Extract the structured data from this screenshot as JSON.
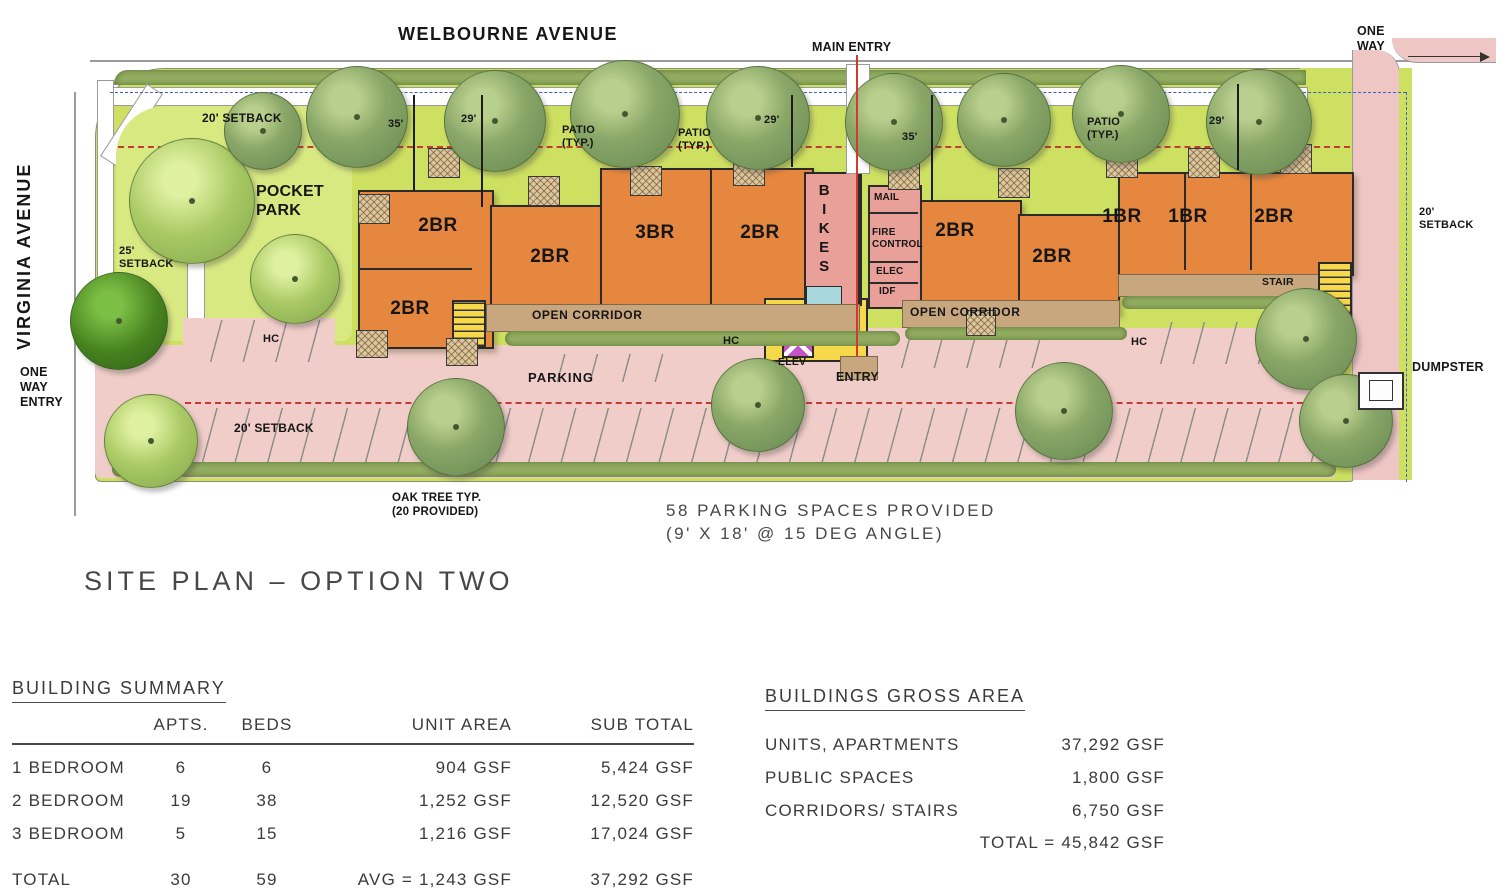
{
  "colors": {
    "building": "#e5873f",
    "grass": "#cde061",
    "grass_light": "#d9e982",
    "hedge": "#94ae62",
    "parking": "#f0cdc8",
    "road": "#eec6c4",
    "tree": "#8aa768",
    "tree_light": "#a9c964",
    "tree_dark": "#47821f",
    "corridor_yellow": "#f7d84b",
    "utility_pink": "#e8a099",
    "elevator": "#c453c8",
    "water": "#a8d7de",
    "walk_tan": "#c9a77e",
    "outline": "#2b2b2b",
    "setback_red": "#c23b35",
    "property_blue": "#3c5fc4"
  },
  "plan": {
    "streets": {
      "welbourne": "WELBOURNE AVENUE",
      "virginia": "VIRGINIA AVENUE",
      "main_entry": "MAIN ENTRY",
      "one_way_top": "ONE\nWAY",
      "one_way_entry": "ONE\nWAY\nENTRY"
    },
    "park": {
      "pocket": "POCKET\nPARK"
    },
    "setbacks": {
      "s20": "20' SETBACK",
      "s20_stacked": "20'\nSETBACK",
      "s25": "25'\nSETBACK"
    },
    "dims": {
      "d35": "35'",
      "d29": "29'"
    },
    "patio": "PATIO\n(TYP.)",
    "units": [
      "2BR",
      "2BR",
      "3BR",
      "2BR",
      "2BR",
      "2BR",
      "2BR",
      "1BR",
      "1BR",
      "2BR"
    ],
    "rooms": {
      "bikes": "BIKES",
      "mail": "MAIL",
      "fire_control": "FIRE\nCONTROL",
      "elec": "ELEC",
      "idf": "IDF",
      "elev": "ELEV",
      "stair": "STAIR"
    },
    "labels": {
      "open_corridor": "OPEN CORRIDOR",
      "entry": "ENTRY",
      "parking": "PARKING",
      "hc": "HC",
      "dumpster": "DUMPSTER"
    },
    "notes": {
      "oak": "OAK TREE TYP.\n(20 PROVIDED)",
      "parking_note": "58 PARKING SPACES PROVIDED\n(9' X 18' @ 15 DEG ANGLE)"
    },
    "title": "SITE PLAN – OPTION TWO"
  },
  "tables": {
    "building_summary": {
      "title": "BUILDING SUMMARY",
      "headers": {
        "apts": "APTS.",
        "beds": "BEDS",
        "unit_area": "UNIT AREA",
        "sub_total": "SUB TOTAL"
      },
      "rows": [
        {
          "label": "1 BEDROOM",
          "apts": "6",
          "beds": "6",
          "unit_area": "904 GSF",
          "sub_total": "5,424  GSF"
        },
        {
          "label": "2 BEDROOM",
          "apts": "19",
          "beds": "38",
          "unit_area": "1,252 GSF",
          "sub_total": "12,520  GSF"
        },
        {
          "label": "3 BEDROOM",
          "apts": "5",
          "beds": "15",
          "unit_area": "1,216 GSF",
          "sub_total": "17,024  GSF"
        }
      ],
      "total": {
        "label": "TOTAL",
        "apts": "30",
        "beds": "59",
        "unit_area": "AVG = 1,243 GSF",
        "sub_total": "37,292  GSF"
      }
    },
    "gross_area": {
      "title": "BUILDINGS GROSS AREA",
      "rows": [
        {
          "label": "UNITS, APARTMENTS",
          "value": "37,292 GSF"
        },
        {
          "label": "PUBLIC SPACES",
          "value": "1,800  GSF"
        },
        {
          "label": "CORRIDORS/ STAIRS",
          "value": "6,750  GSF"
        }
      ],
      "total": "TOTAL = 45,842 GSF"
    }
  }
}
